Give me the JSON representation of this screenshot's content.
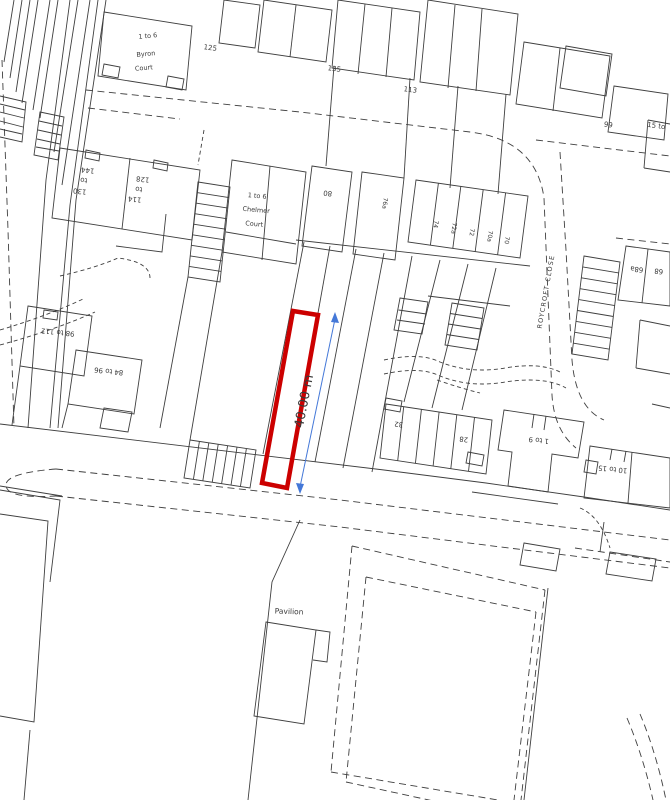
{
  "map": {
    "type": "site-location-plan",
    "background": "#ffffff",
    "line_color": "#3f3f3f",
    "text_color": "#3a3a3a",
    "highlight_plot": {
      "color": "#cc0000"
    },
    "dimension": {
      "text": "40.00 m",
      "color": "#4478d8"
    },
    "labels": [
      {
        "id": "label-byron-range",
        "text": "1 to 6",
        "x": 148,
        "y": 38,
        "r": -5,
        "s": 6.5
      },
      {
        "id": "label-byron-name",
        "text": "Byron",
        "x": 146,
        "y": 56,
        "r": -5,
        "s": 6.5
      },
      {
        "id": "label-byron-court",
        "text": "Court",
        "x": 144,
        "y": 70,
        "r": -5,
        "s": 6.5
      },
      {
        "id": "label-125",
        "text": "125",
        "x": 210,
        "y": 50,
        "r": 8,
        "s": 7
      },
      {
        "id": "label-135",
        "text": "135",
        "x": 334,
        "y": 71,
        "r": 8,
        "s": 7
      },
      {
        "id": "label-113",
        "text": "113",
        "x": 410,
        "y": 92,
        "r": 8,
        "s": 7
      },
      {
        "id": "label-99",
        "text": "99",
        "x": 608,
        "y": 127,
        "r": 8,
        "s": 7
      },
      {
        "id": "label-15-to",
        "text": "15 to",
        "x": 656,
        "y": 128,
        "r": 8,
        "s": 7
      },
      {
        "id": "label-144",
        "text": "144",
        "x": 88,
        "y": 168,
        "r": 186,
        "s": 7
      },
      {
        "id": "label-144-to",
        "text": "to",
        "x": 84,
        "y": 178,
        "r": 186,
        "s": 7
      },
      {
        "id": "label-130",
        "text": "130",
        "x": 80,
        "y": 189,
        "r": 186,
        "s": 7
      },
      {
        "id": "label-128",
        "text": "128",
        "x": 143,
        "y": 177,
        "r": 186,
        "s": 7
      },
      {
        "id": "label-128-to",
        "text": "to",
        "x": 139,
        "y": 187,
        "r": 186,
        "s": 7
      },
      {
        "id": "label-114",
        "text": "114",
        "x": 135,
        "y": 197,
        "r": 186,
        "s": 7
      },
      {
        "id": "label-chelmer-range",
        "text": "1 to 6",
        "x": 257,
        "y": 198,
        "r": 5,
        "s": 6.5
      },
      {
        "id": "label-chelmer-name",
        "text": "Chelmer",
        "x": 256,
        "y": 212,
        "r": 5,
        "s": 6.5
      },
      {
        "id": "label-chelmer-court",
        "text": "Court",
        "x": 254,
        "y": 226,
        "r": 5,
        "s": 6.5
      },
      {
        "id": "label-80",
        "text": "80",
        "x": 328,
        "y": 191,
        "r": 186,
        "s": 7
      },
      {
        "id": "label-76a",
        "text": "76a",
        "x": 383,
        "y": 203,
        "r": 97,
        "s": 6
      },
      {
        "id": "label-74",
        "text": "74",
        "x": 434,
        "y": 224,
        "r": 97,
        "s": 6
      },
      {
        "id": "label-72a",
        "text": "72a",
        "x": 452,
        "y": 228,
        "r": 97,
        "s": 6
      },
      {
        "id": "label-72",
        "text": "72",
        "x": 470,
        "y": 232,
        "r": 97,
        "s": 6
      },
      {
        "id": "label-70a",
        "text": "70a",
        "x": 488,
        "y": 236,
        "r": 97,
        "s": 6
      },
      {
        "id": "label-70",
        "text": "70",
        "x": 505,
        "y": 240,
        "r": 97,
        "s": 6
      },
      {
        "id": "label-68a",
        "text": "68a",
        "x": 637,
        "y": 267,
        "r": 186,
        "s": 7
      },
      {
        "id": "label-68",
        "text": "68",
        "x": 659,
        "y": 269,
        "r": 186,
        "s": 7
      },
      {
        "id": "label-roycroft-close",
        "text": "ROYCROFT CLOSE",
        "x": 548,
        "y": 292,
        "r": -80,
        "s": 6.5,
        "sp": 1.2
      },
      {
        "id": "label-98-112",
        "text": "98 to 112",
        "x": 58,
        "y": 330,
        "r": 186,
        "s": 7
      },
      {
        "id": "label-84-96",
        "text": "84 to 96",
        "x": 109,
        "y": 369,
        "r": 186,
        "s": 7
      },
      {
        "id": "label-32",
        "text": "32",
        "x": 399,
        "y": 422,
        "r": 186,
        "s": 7
      },
      {
        "id": "label-28",
        "text": "28",
        "x": 464,
        "y": 437,
        "r": 186,
        "s": 7
      },
      {
        "id": "label-1-9",
        "text": "1 to 9",
        "x": 539,
        "y": 438,
        "r": 186,
        "s": 7
      },
      {
        "id": "label-10-15",
        "text": "10 to 15",
        "x": 613,
        "y": 467,
        "r": 186,
        "s": 7
      },
      {
        "id": "label-pavilion",
        "text": "Pavilion",
        "x": 289,
        "y": 614,
        "r": 2,
        "s": 7.5
      },
      {
        "id": "label-dimension",
        "text": "40.00 m",
        "x": 308,
        "y": 402,
        "r": -79,
        "s": 13,
        "color": "#4478d8"
      }
    ]
  }
}
